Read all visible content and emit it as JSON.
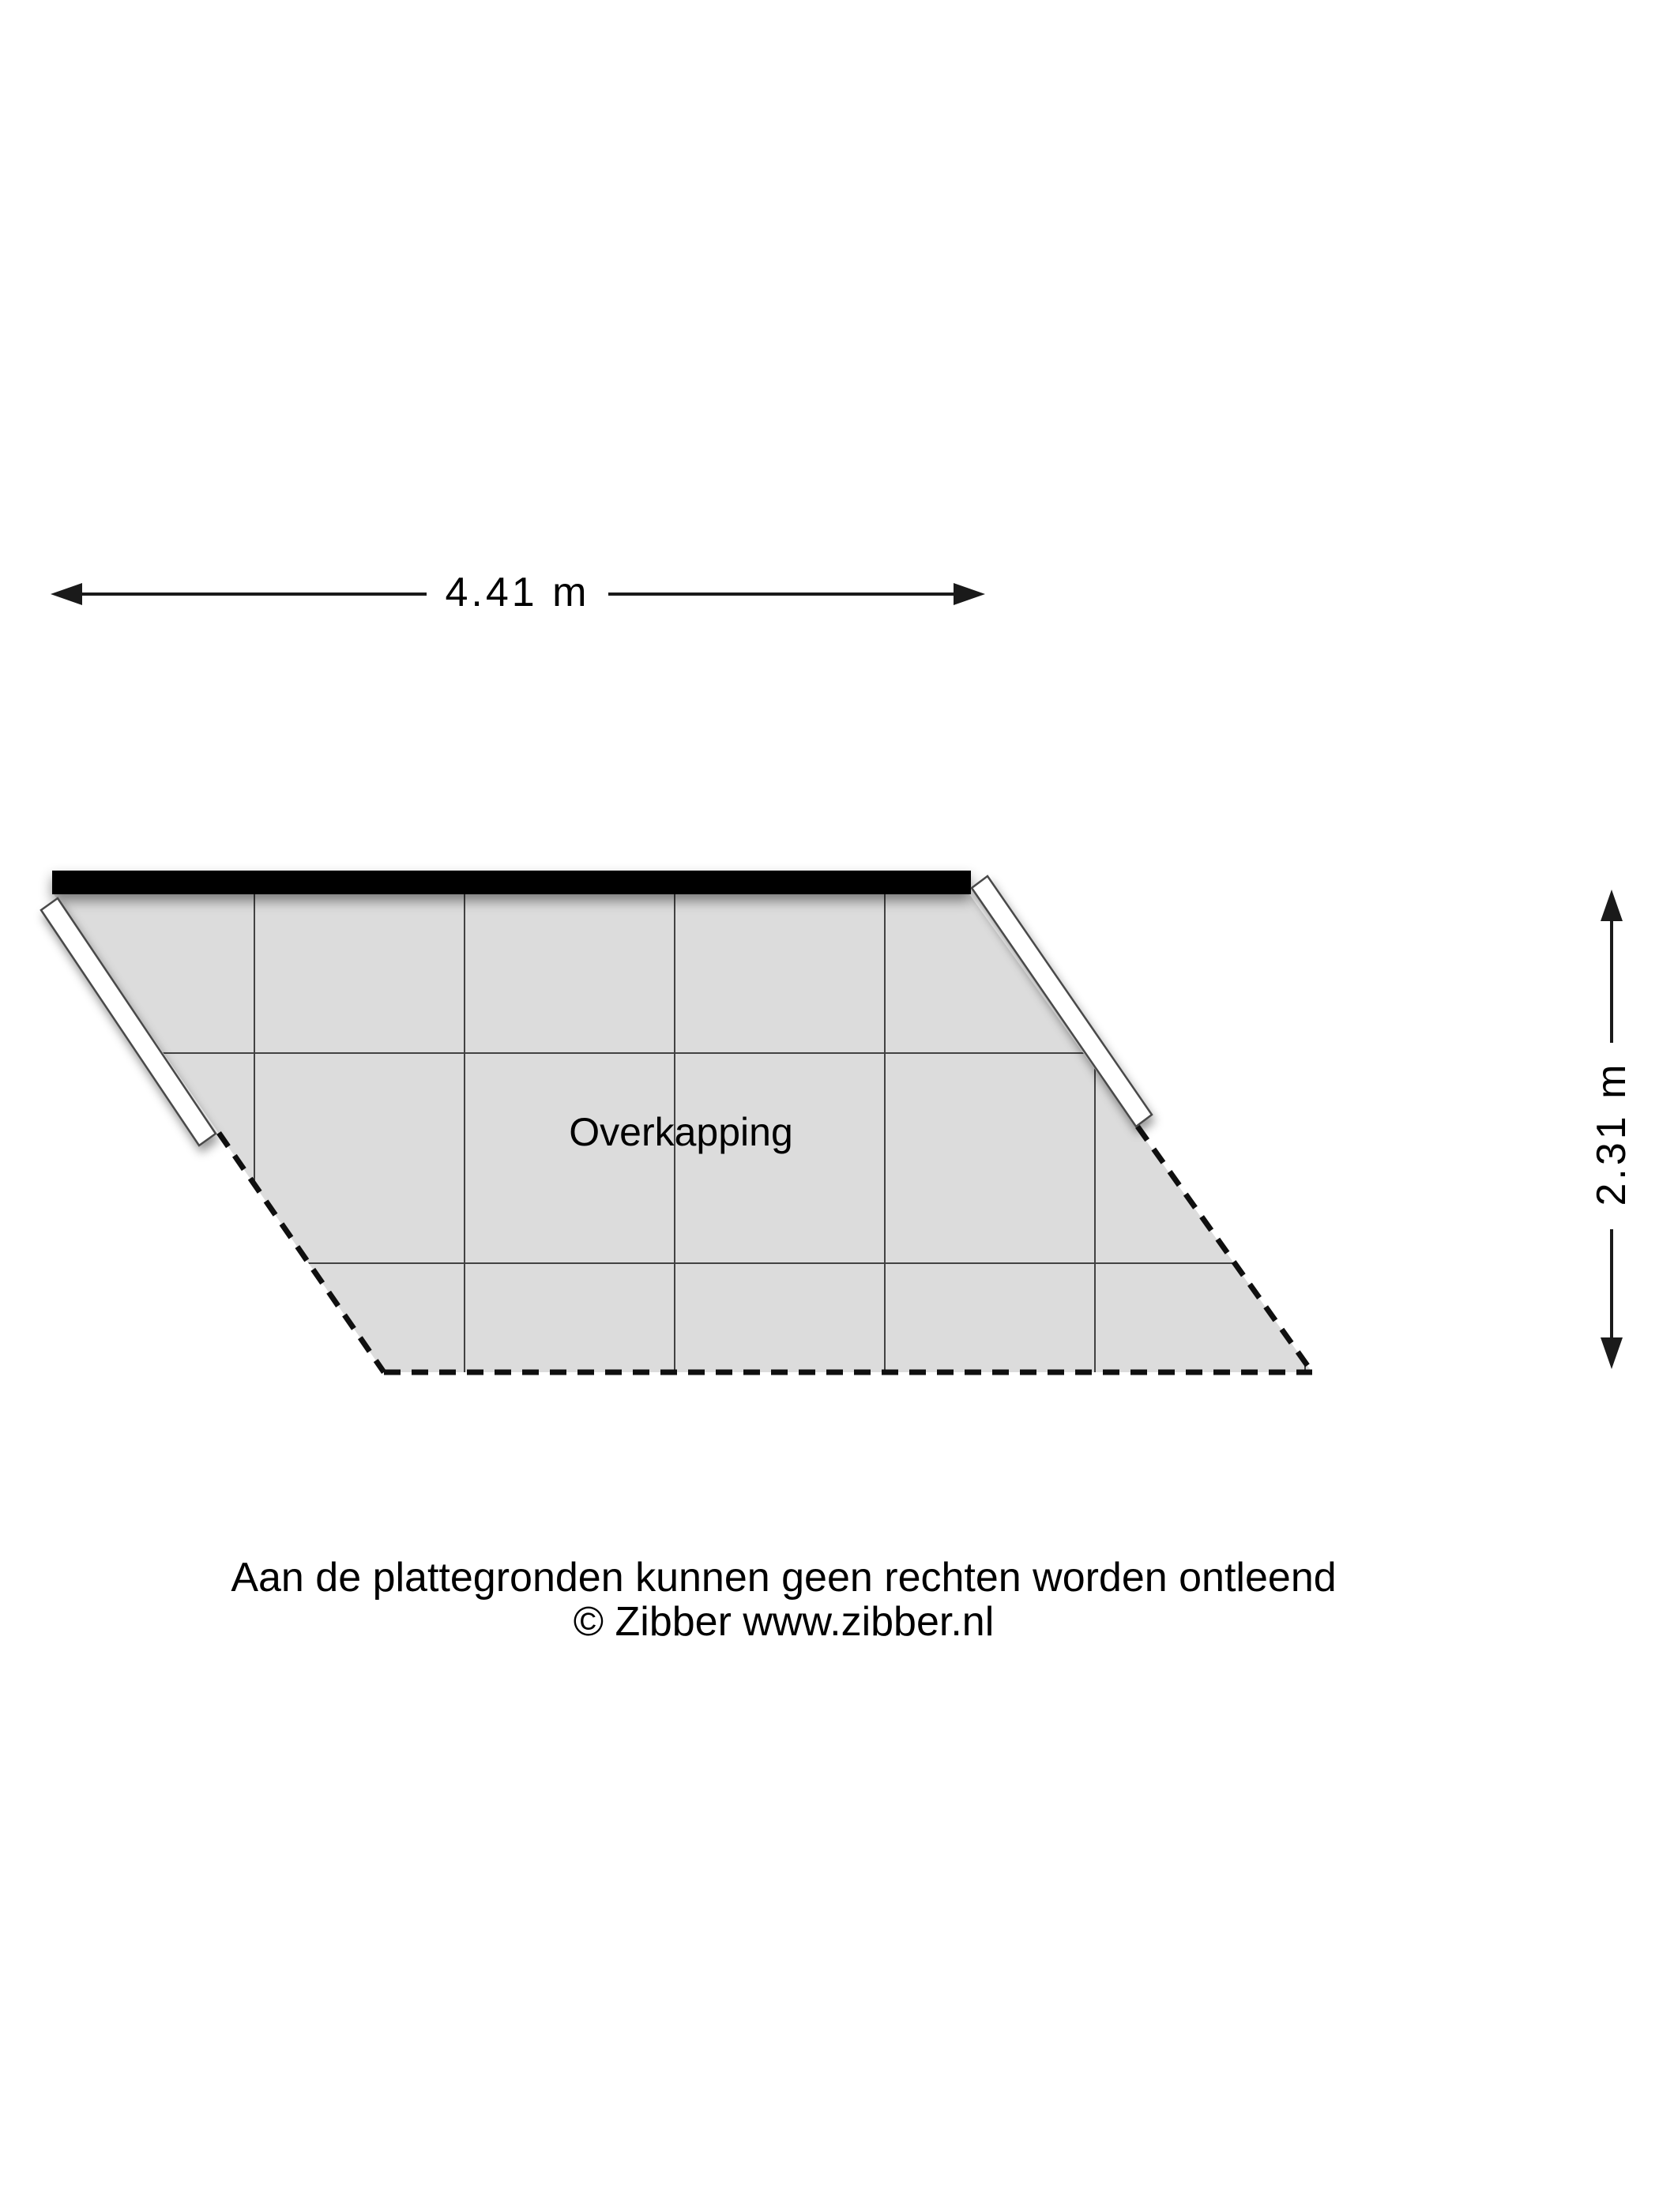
{
  "floorplan": {
    "room": {
      "label": "Overkapping"
    },
    "dimensions": {
      "width_label": "4.41 m",
      "height_label": "2.31 m"
    },
    "colors": {
      "floor_fill": "#dcdcdc",
      "grid_line": "#424242",
      "wall_solid": "#000000",
      "dashed_edge": "#0f0f0f",
      "open_wall_fill": "#ffffff",
      "open_wall_stroke": "#4a4a4a",
      "dimension": "#1a1a1a"
    }
  },
  "footer": {
    "disclaimer": "Aan de plattegronden kunnen geen rechten worden ontleend",
    "copyright": "© Zibber www.zibber.nl"
  }
}
